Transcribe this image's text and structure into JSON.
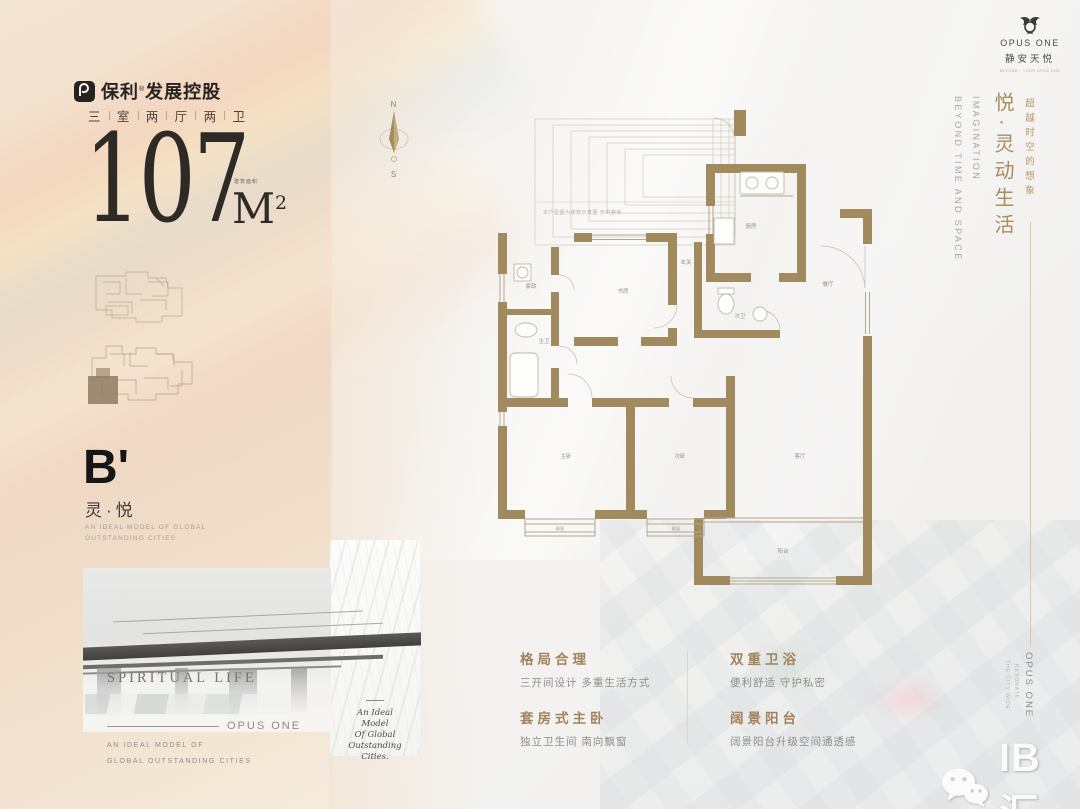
{
  "brand": {
    "cn": "保利",
    "reg": "®",
    "suffix": "发展控股"
  },
  "project": {
    "name_en": "OPUS ONE",
    "name_cn": "静安天悦",
    "tagline": "BEYOND · YOUR OPUS ONE"
  },
  "unit": {
    "spec": [
      "三",
      "室",
      "两",
      "厅",
      "两",
      "卫"
    ],
    "area": "107",
    "area_unit": "M",
    "area_sup": "2",
    "area_note": "建筑面积",
    "code": "B'",
    "name": "灵·悦",
    "caption_line1": "AN IDEAL MODEL OF GLOBAL",
    "caption_line2": "OUTSTANDING CITIES"
  },
  "photo": {
    "title": "SPIRITUAL LIFE",
    "brand_line": "OPUS ONE",
    "caption_line1": "AN IDEAL MODEL OF",
    "caption_line2": "GLOBAL OUTSTANDING CITIES",
    "script_lines": [
      "An Ideal",
      "Model",
      "Of Global",
      "Outstanding",
      "Cities."
    ]
  },
  "right_panel": {
    "headline": "悦·灵动生活",
    "subline": "超越时空的想象",
    "en_line1": "IMAGINATION",
    "en_line2": "BEYOND TIME AND SPACE",
    "bottom_vertical": "OPUS ONE",
    "bottom_small1": "RESONATE",
    "bottom_small2": "THE CITY WIDE"
  },
  "features": [
    {
      "title": "格局合理",
      "desc": "三开间设计 多重生活方式"
    },
    {
      "title": "套房式主卧",
      "desc": "独立卫生间 南向飘窗"
    },
    {
      "title": "双重卫浴",
      "desc": "便利舒适 守护私密"
    },
    {
      "title": "阔景阳台",
      "desc": "阔景阳台升级空间通透感"
    }
  ],
  "compass": {
    "north": "N",
    "south": "S"
  },
  "floor_plan": {
    "disclaimer": "本户型图为装修示意图 仅供参考",
    "rooms": {
      "kitchen": "厨房",
      "dining": "餐厅",
      "living": "客厅",
      "balcony": "阳台",
      "master": "主卧",
      "second": "次卧",
      "study": "书房",
      "master_bath": "主卫",
      "second_bath": "次卫",
      "foyer": "玄关",
      "utility": "家政",
      "bay1": "飘窗",
      "bay2": "飘窗"
    }
  },
  "watermark": {
    "text": "IB汇"
  },
  "colors": {
    "gold": "#a2865c",
    "wall": "#a28a5f",
    "text_dark": "#2c2926",
    "muted": "#8f8d89"
  }
}
